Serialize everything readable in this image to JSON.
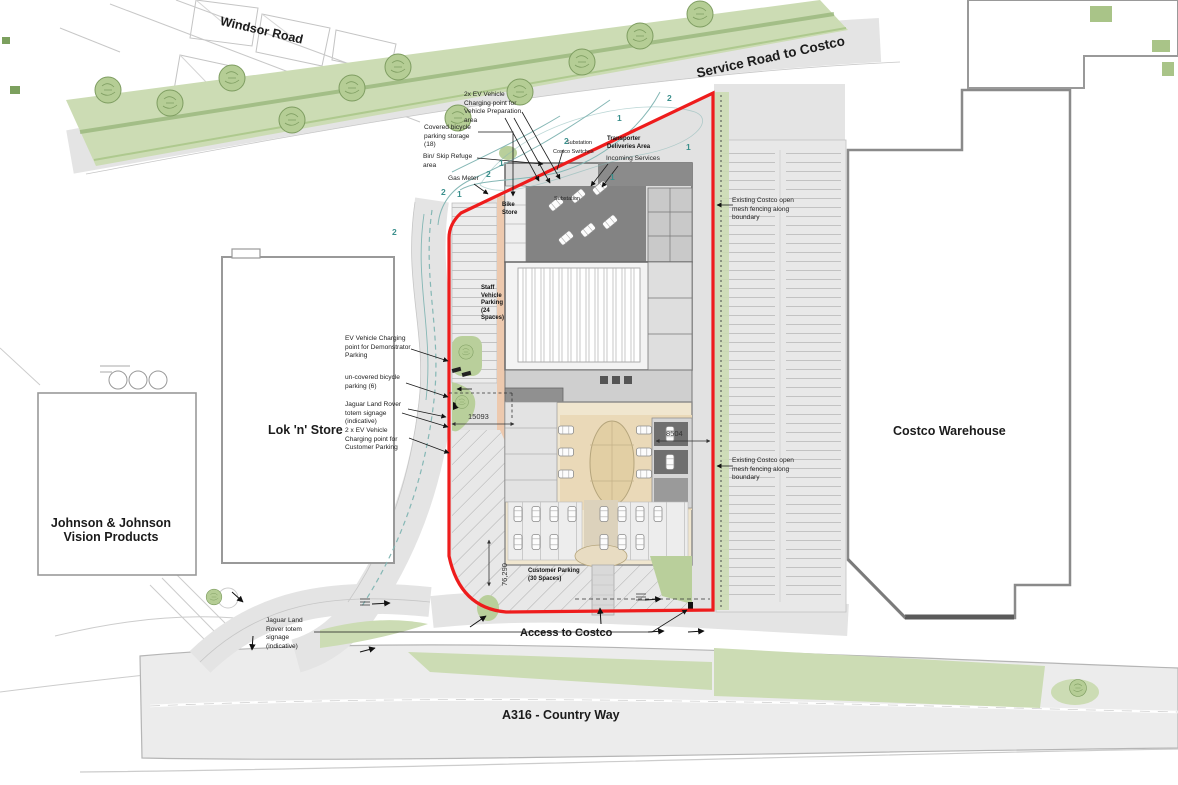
{
  "roads": {
    "windsor_road": "Windsor Road",
    "service_road": "Service Road to Costco",
    "access_road": "Access to Costco",
    "a316": "A316 - Country Way"
  },
  "buildings": {
    "lok_n_store": "Lok 'n' Store",
    "jnj_line1": "Johnson & Johnson",
    "jnj_line2": "Vision Products",
    "costco_warehouse": "Costco Warehouse"
  },
  "site": {
    "transporter_deliveries": "Transporter Deliveries Area",
    "staff_parking": "Staff Vehicle Parking (24 Spaces)",
    "customer_parking": "Customer Parking (30 Spaces)",
    "bike_store": "Bike Store"
  },
  "annotations": [
    {
      "text": "2x EV Vehicle Charging point for Vehicle Preparation area"
    },
    {
      "text": "Covered bicycle parking storage (18)"
    },
    {
      "text": "Bin/ Skip Refuge area"
    },
    {
      "text": "Gas Meter"
    },
    {
      "text": "EV Vehicle Charging point for Demonstrator Parking"
    },
    {
      "text": "un-covered bicycle parking (6)"
    },
    {
      "text": "Jaguar Land Rover totem signage (indicative)"
    },
    {
      "text": "2 x EV Vehicle Charging point for Customer Parking"
    },
    {
      "text": "Existing Costco open mesh fencing along boundary"
    },
    {
      "text": "Existing Costco open mesh fencing along boundary"
    },
    {
      "text": "Jaguar Land Rover totem signage (indicative)"
    },
    {
      "text": "Incoming Services"
    },
    {
      "text": "Substation"
    },
    {
      "text": "Costco Switches"
    },
    {
      "text": "Substation"
    }
  ],
  "dimensions": {
    "frontage": "15093",
    "east_gap": "8504",
    "west_depth": "76,290"
  },
  "swept_path_markers": [
    "2",
    "1",
    "2",
    "1",
    "2",
    "1",
    "2",
    "1",
    "2",
    "1"
  ],
  "colors": {
    "boundary_red": "#ee1c1c",
    "landscape_green": "#ccdcb4",
    "road_gray": "#e4e4e4",
    "swept_path_teal": "#5f9ea0",
    "building_dark": "#7b7b7b",
    "showroom_beige": "#f0e6cf"
  }
}
